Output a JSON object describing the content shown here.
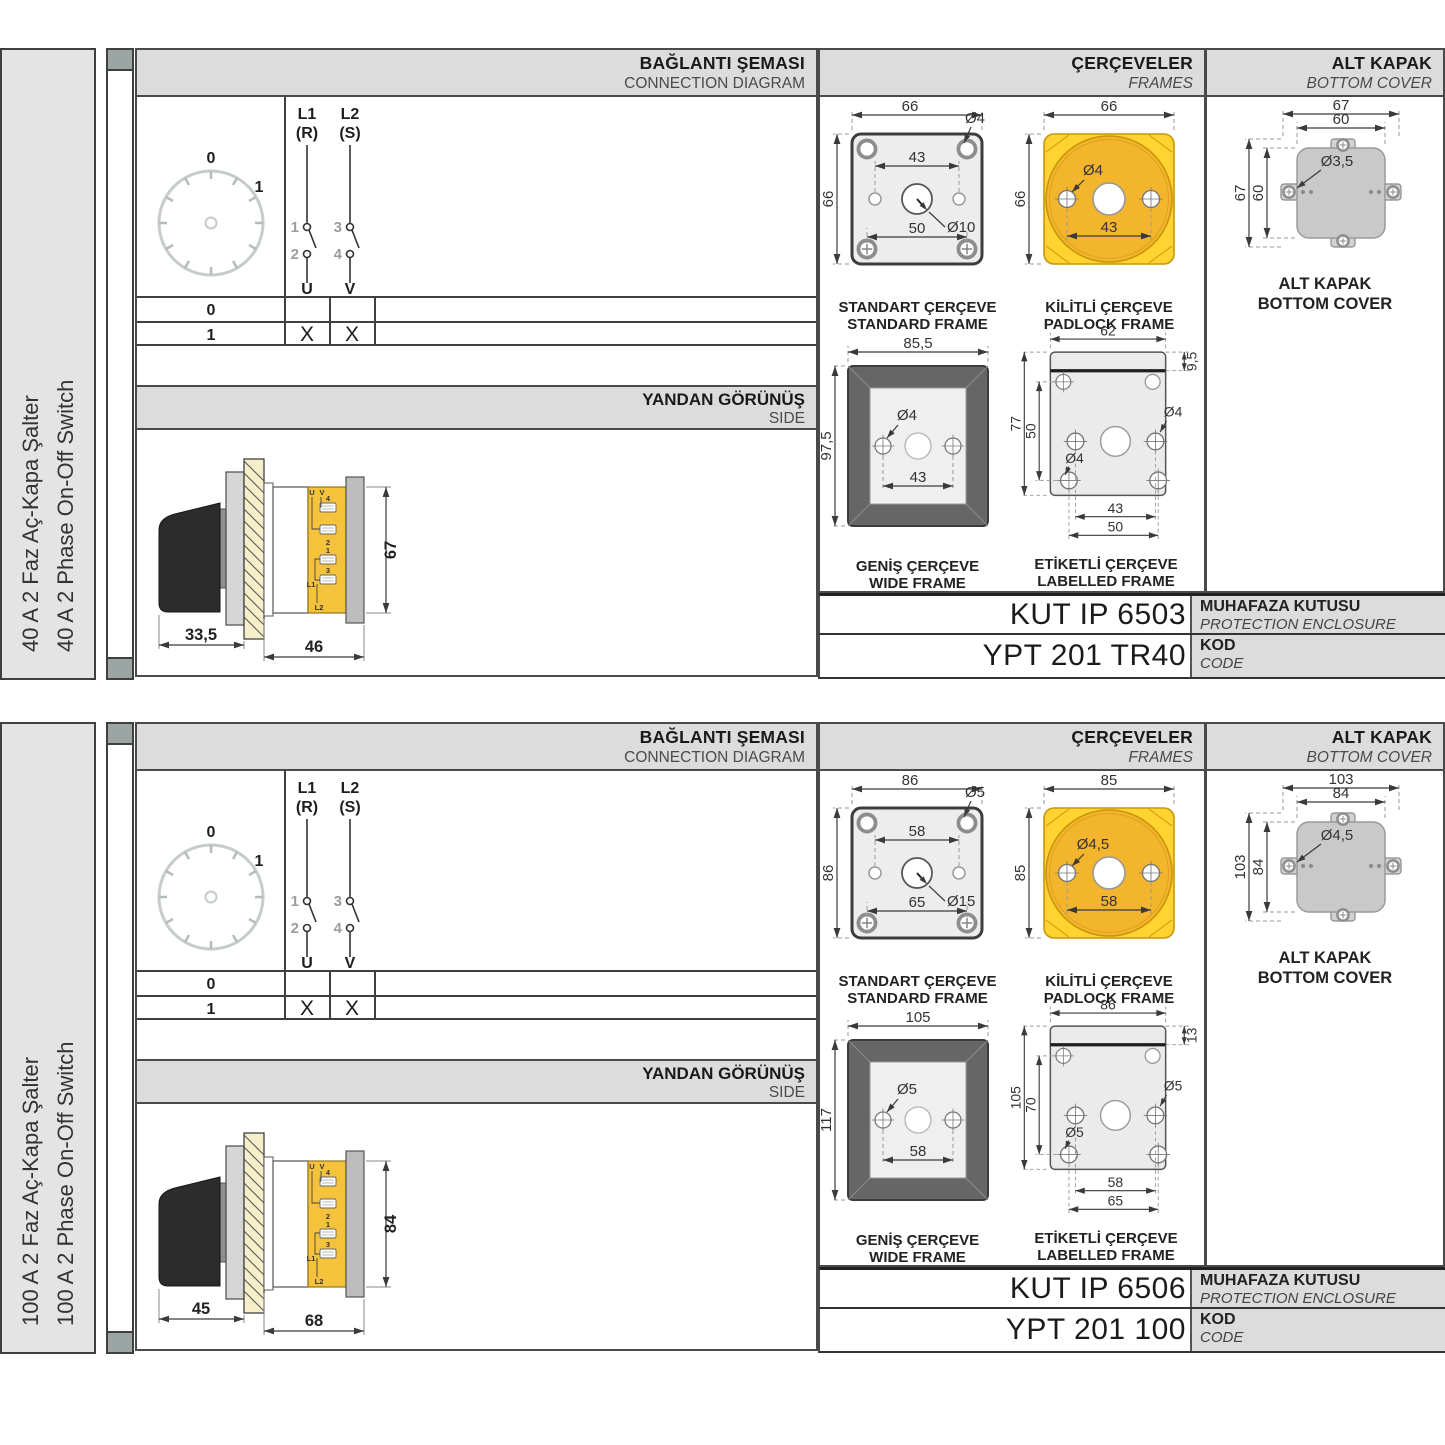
{
  "accent_colors": {
    "padlock_yellow": "#FFD330",
    "terminal_yellow": "#F5C23B"
  },
  "panels": [
    {
      "side_label_tr": "40 A 2 Faz Aç-Kapa Şalter",
      "side_label_en": "40 A 2 Phase On-Off Switch",
      "headers": {
        "diagram_tr": "BAĞLANTI ŞEMASI",
        "diagram_en": "CONNECTION DIAGRAM",
        "frames_tr": "ÇERÇEVELER",
        "frames_en": "FRAMES",
        "cover_tr": "ALT KAPAK",
        "cover_en": "BOTTOM COVER",
        "side_tr": "YANDAN GÖRÜNÜŞ",
        "side_en": "SIDE"
      },
      "diagram": {
        "dial": {
          "pos0": "0",
          "pos1": "1"
        },
        "sw": {
          "l1": "L1",
          "l1_sub": "(R)",
          "l2": "L2",
          "l2_sub": "(S)",
          "t1": "1",
          "t2": "2",
          "t3": "3",
          "t4": "4",
          "u": "U",
          "v": "V"
        },
        "table": {
          "row0": "0",
          "row1": "1",
          "x_u": "X",
          "x_v": "X"
        }
      },
      "side_view": {
        "d_knob": "33,5",
        "d_body": "46",
        "d_height": "67",
        "terminals": {
          "u": "U",
          "v": "V",
          "n4": "4",
          "n2": "2",
          "n1": "1",
          "n3": "3",
          "l1": "L1",
          "l2": "L2"
        }
      },
      "frames": {
        "standard": {
          "title_tr": "STANDART ÇERÇEVE",
          "title_en": "STANDARD FRAME",
          "d_w": "66",
          "d_h": "66",
          "d_hole": "Ø4",
          "d_top": "43",
          "d_center": "Ø10",
          "d_bottom": "50"
        },
        "padlock": {
          "title_tr": "KİLİTLİ ÇERÇEVE",
          "title_en": "PADLOCK FRAME",
          "d_w": "66",
          "d_h": "66",
          "d_hole": "Ø4",
          "d_sp": "43"
        },
        "wide": {
          "title_tr": "GENİŞ ÇERÇEVE",
          "title_en": "WIDE FRAME",
          "d_w": "85,5",
          "d_h": "97,5",
          "d_hole": "Ø4",
          "d_sp": "43"
        },
        "labelled": {
          "title_tr": "ETİKETLİ ÇERÇEVE",
          "title_en": "LABELLED FRAME",
          "d_w": "62",
          "d_band": "9,5",
          "d_h": "77",
          "d_inner": "50",
          "d_hole_r": "Ø4",
          "d_hole_l": "Ø4",
          "d_sp1": "43",
          "d_sp2": "50"
        }
      },
      "cover": {
        "label_tr": "ALT KAPAK",
        "label_en": "BOTTOM COVER",
        "d_w1": "67",
        "d_w2": "60",
        "d_hole": "Ø3,5",
        "d_h1": "67",
        "d_h2": "60"
      },
      "codes": {
        "enclosure_value": "KUT IP 6503",
        "enclosure_label_tr": "MUHAFAZA KUTUSU",
        "enclosure_label_en": "PROTECTION ENCLOSURE",
        "code_value": "YPT 201 TR40",
        "code_label_tr": "KOD",
        "code_label_en": "CODE"
      }
    },
    {
      "side_label_tr": "100 A 2 Faz Aç-Kapa Şalter",
      "side_label_en": "100 A 2 Phase On-Off Switch",
      "headers": {
        "diagram_tr": "BAĞLANTI ŞEMASI",
        "diagram_en": "CONNECTION DIAGRAM",
        "frames_tr": "ÇERÇEVELER",
        "frames_en": "FRAMES",
        "cover_tr": "ALT KAPAK",
        "cover_en": "BOTTOM COVER",
        "side_tr": "YANDAN GÖRÜNÜŞ",
        "side_en": "SIDE"
      },
      "diagram": {
        "dial": {
          "pos0": "0",
          "pos1": "1"
        },
        "sw": {
          "l1": "L1",
          "l1_sub": "(R)",
          "l2": "L2",
          "l2_sub": "(S)",
          "t1": "1",
          "t2": "2",
          "t3": "3",
          "t4": "4",
          "u": "U",
          "v": "V"
        },
        "table": {
          "row0": "0",
          "row1": "1",
          "x_u": "X",
          "x_v": "X"
        }
      },
      "side_view": {
        "d_knob": "45",
        "d_body": "68",
        "d_height": "84",
        "terminals": {
          "u": "U",
          "v": "V",
          "n4": "4",
          "n2": "2",
          "n1": "1",
          "n3": "3",
          "l1": "L1",
          "l2": "L2"
        }
      },
      "frames": {
        "standard": {
          "title_tr": "STANDART ÇERÇEVE",
          "title_en": "STANDARD FRAME",
          "d_w": "86",
          "d_h": "86",
          "d_hole": "Ø5",
          "d_top": "58",
          "d_center": "Ø15",
          "d_bottom": "65"
        },
        "padlock": {
          "title_tr": "KİLİTLİ ÇERÇEVE",
          "title_en": "PADLOCK FRAME",
          "d_w": "85",
          "d_h": "85",
          "d_hole": "Ø4,5",
          "d_sp": "58"
        },
        "wide": {
          "title_tr": "GENİŞ ÇERÇEVE",
          "title_en": "WIDE FRAME",
          "d_w": "105",
          "d_h": "117",
          "d_hole": "Ø5",
          "d_sp": "58"
        },
        "labelled": {
          "title_tr": "ETİKETLİ ÇERÇEVE",
          "title_en": "LABELLED FRAME",
          "d_w": "86",
          "d_band": "13",
          "d_h": "105",
          "d_inner": "70",
          "d_hole_r": "Ø5",
          "d_hole_l": "Ø5",
          "d_sp1": "58",
          "d_sp2": "65"
        }
      },
      "cover": {
        "label_tr": "ALT KAPAK",
        "label_en": "BOTTOM COVER",
        "d_w1": "103",
        "d_w2": "84",
        "d_hole": "Ø4,5",
        "d_h1": "103",
        "d_h2": "84"
      },
      "codes": {
        "enclosure_value": "KUT IP 6506",
        "enclosure_label_tr": "MUHAFAZA KUTUSU",
        "enclosure_label_en": "PROTECTION ENCLOSURE",
        "code_value": "YPT 201 100",
        "code_label_tr": "KOD",
        "code_label_en": "CODE"
      }
    }
  ]
}
